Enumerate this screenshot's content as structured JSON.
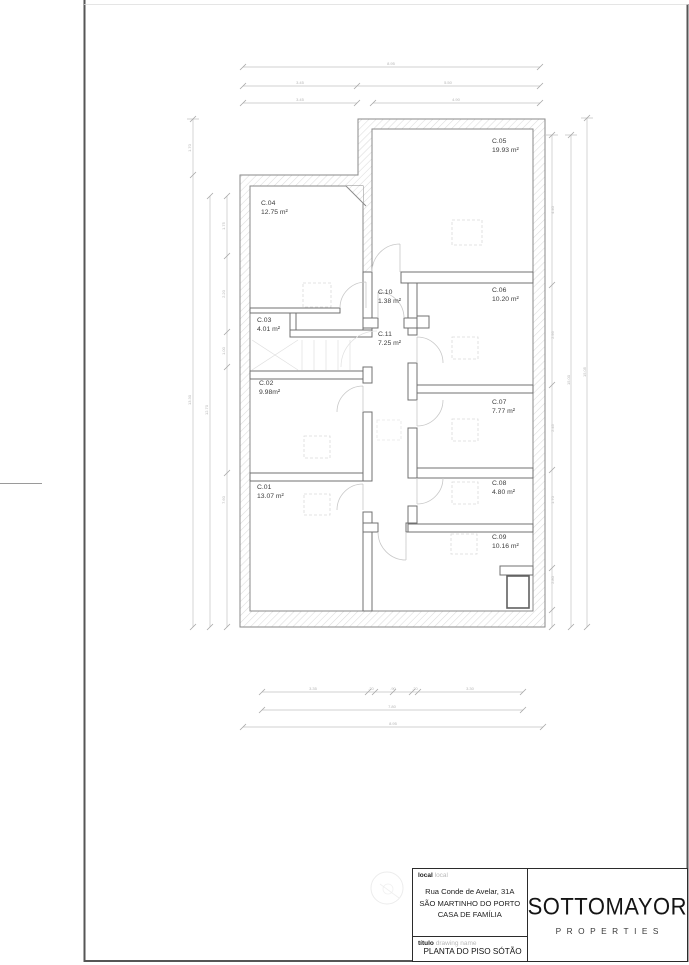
{
  "title_block": {
    "local_label_pt": "local",
    "local_label_en": "local",
    "address_line1": "Rua Conde de Avelar, 31A",
    "address_line2": "SÃO MARTINHO DO PORTO",
    "address_line3": "CASA DE FAMÍLIA",
    "titulo_label_pt": "título",
    "titulo_label_en": "drawing name",
    "drawing_name": "PLANTA DO PISO SÓTÃO",
    "brand_name": "SOTTOMAYOR",
    "brand_subtitle": "PROPERTIES"
  },
  "floor_plan": {
    "rooms": [
      {
        "id": "C.01",
        "area": "13.07 m²"
      },
      {
        "id": "C.02",
        "area": "9.98m²"
      },
      {
        "id": "C.03",
        "area": "4.01 m²"
      },
      {
        "id": "C.04",
        "area": "12.75 m²"
      },
      {
        "id": "C.05",
        "area": "19.93 m²"
      },
      {
        "id": "C.06",
        "area": "10.20 m²"
      },
      {
        "id": "C.07",
        "area": "7.77 m²"
      },
      {
        "id": "C.08",
        "area": "4.80 m²"
      },
      {
        "id": "C.09",
        "area": "10.16 m²"
      },
      {
        "id": "C.10",
        "area": "1.38 m²"
      },
      {
        "id": "C.11",
        "area": "7.25 m²"
      }
    ],
    "dims": {
      "top": [
        "8.95",
        "3.45",
        "5.50",
        "3.45",
        "4.90"
      ],
      "left": [
        "1.70",
        "13.30",
        "12.70",
        "1.75",
        "2.20",
        "1.00",
        "7.60"
      ],
      "right": [
        "4.40",
        "2.95",
        "2.45",
        "1.70",
        "2.80",
        "15.00",
        "15.05"
      ],
      "bottom": [
        "3.35",
        ".20",
        ".90",
        ".20",
        "3.30",
        "7.80",
        "8.95"
      ]
    }
  }
}
